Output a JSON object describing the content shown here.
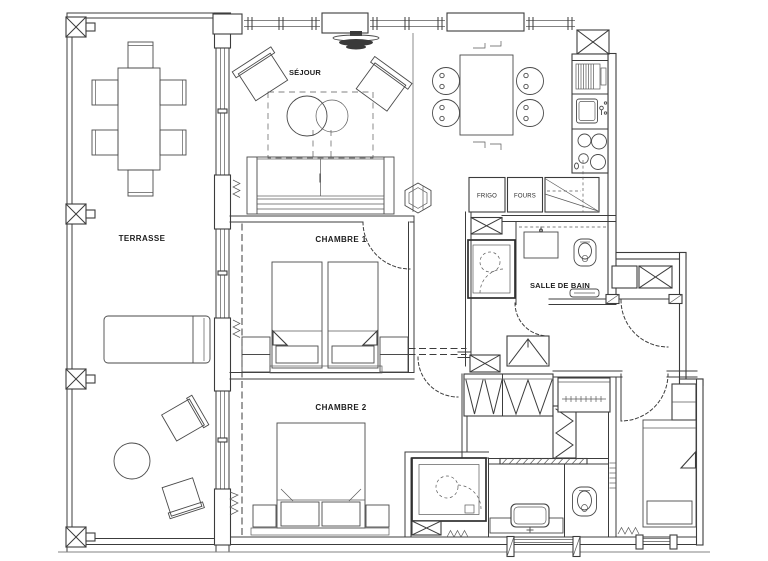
{
  "document": {
    "type": "apartment floor plan drawing",
    "background_color": "#ffffff",
    "ink_color": "#3c3c3c"
  },
  "plan": {
    "rooms": {
      "terrasse": {
        "label": "TERRASSE"
      },
      "sejour": {
        "label": "SÉJOUR"
      },
      "chambre1": {
        "label": "CHAMBRE 1"
      },
      "chambre2": {
        "label": "CHAMBRE 2"
      },
      "salle_de_bain": {
        "label": "SALLE DE BAIN"
      }
    },
    "kitchen": {
      "frigo_label": "FRIGO",
      "fours_label": "FOURS"
    }
  }
}
